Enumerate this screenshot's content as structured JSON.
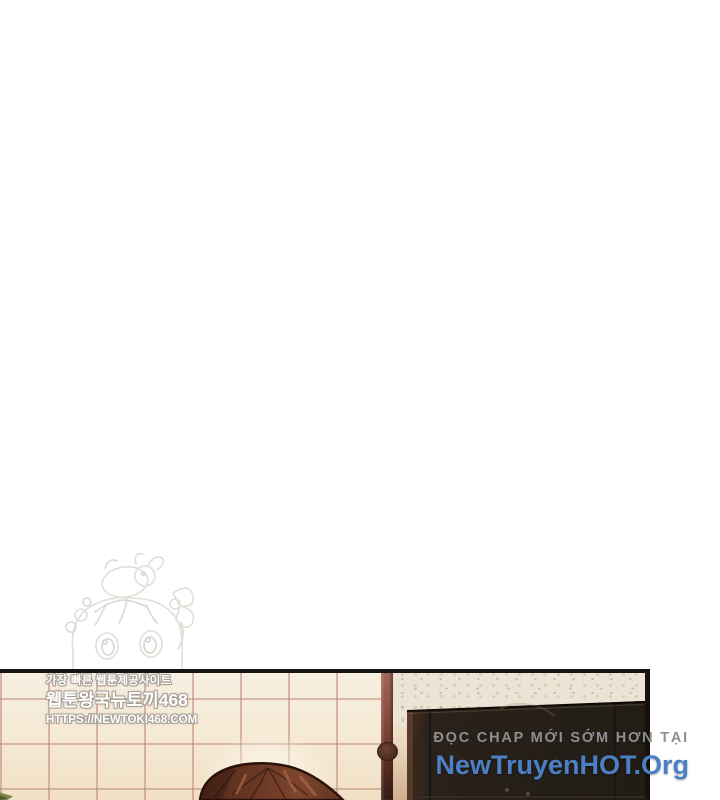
{
  "korean_watermark": {
    "line1": "가장 빠른 웹툰제공사이트",
    "line2": "웹툰왕국뉴토끼468",
    "line3": "HTTPS://NEWTOKI468.COM"
  },
  "viet_watermark": {
    "line1": "ĐỌC CHAP MỚI SỚM HƠN TẠI",
    "line2": "NewTruyenHOT.Org"
  },
  "colors": {
    "page_background": "#ffffff",
    "viet_line1_gray": "#8f8f91",
    "viet_line2_blue": "#4b80c5",
    "korean_text_fill": "#ffffff",
    "korean_text_outline": "#a8a096",
    "lattice_wall_cream": "#f5e9d4",
    "lattice_grid_line": "#bb8674",
    "wood_beam": "#7c463a",
    "wallpaper_beige": "#ebe4d4",
    "cabinet_dark_brown": "#262019",
    "hair_brown": "#6e3a26",
    "panel_border_black": "#171310",
    "leaf_green": "#7f864a"
  },
  "scene": {
    "panel_description": "Bottom edge of a webtoon panel: room interior with shoji lattice wall, dark wardrobe, top of a brown-haired head",
    "mascot_description": "Faint sketch watermark of chibi girl with bunny on head"
  }
}
